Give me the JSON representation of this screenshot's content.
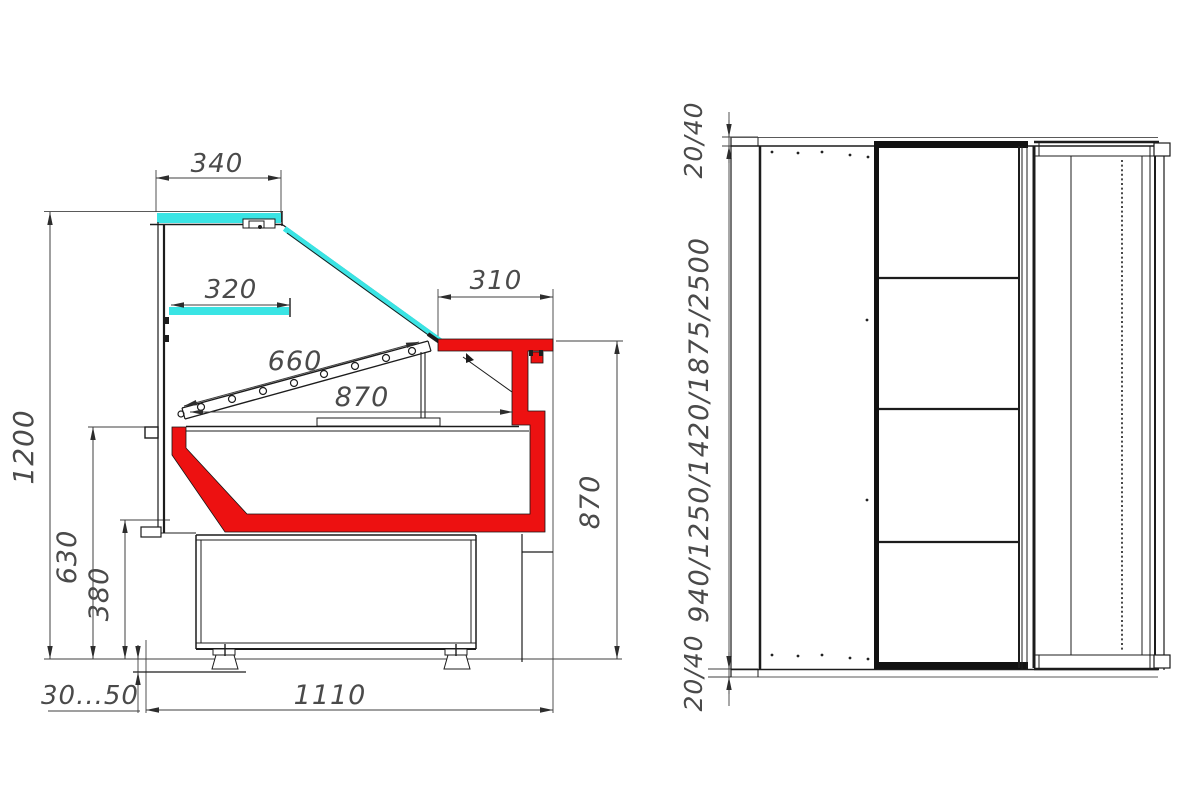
{
  "drawing": {
    "type": "technical dimension drawing",
    "subject": "serve-over refrigerated display counter - side cross-section and plan view",
    "units": "mm"
  },
  "side_view": {
    "canopy_width": "340",
    "shelf_width": "320",
    "counter_depth": "310",
    "glass_length": "660",
    "display_depth": "870",
    "overall_height": "1200",
    "deck_height": "630",
    "basin_height": "380",
    "counter_height": "870",
    "base_depth": "1110",
    "feet_adjust": "30...50"
  },
  "plan_view": {
    "end_panel_top": "20/40",
    "module_lengths": "940/1250/1420/1875/2500",
    "end_panel_bottom": "20/40"
  },
  "colors": {
    "glass_cyan": "#3ae4e4",
    "accent_red": "#ed1111",
    "outline": "#1c1c1c",
    "dimension": "#3f3f3f"
  }
}
